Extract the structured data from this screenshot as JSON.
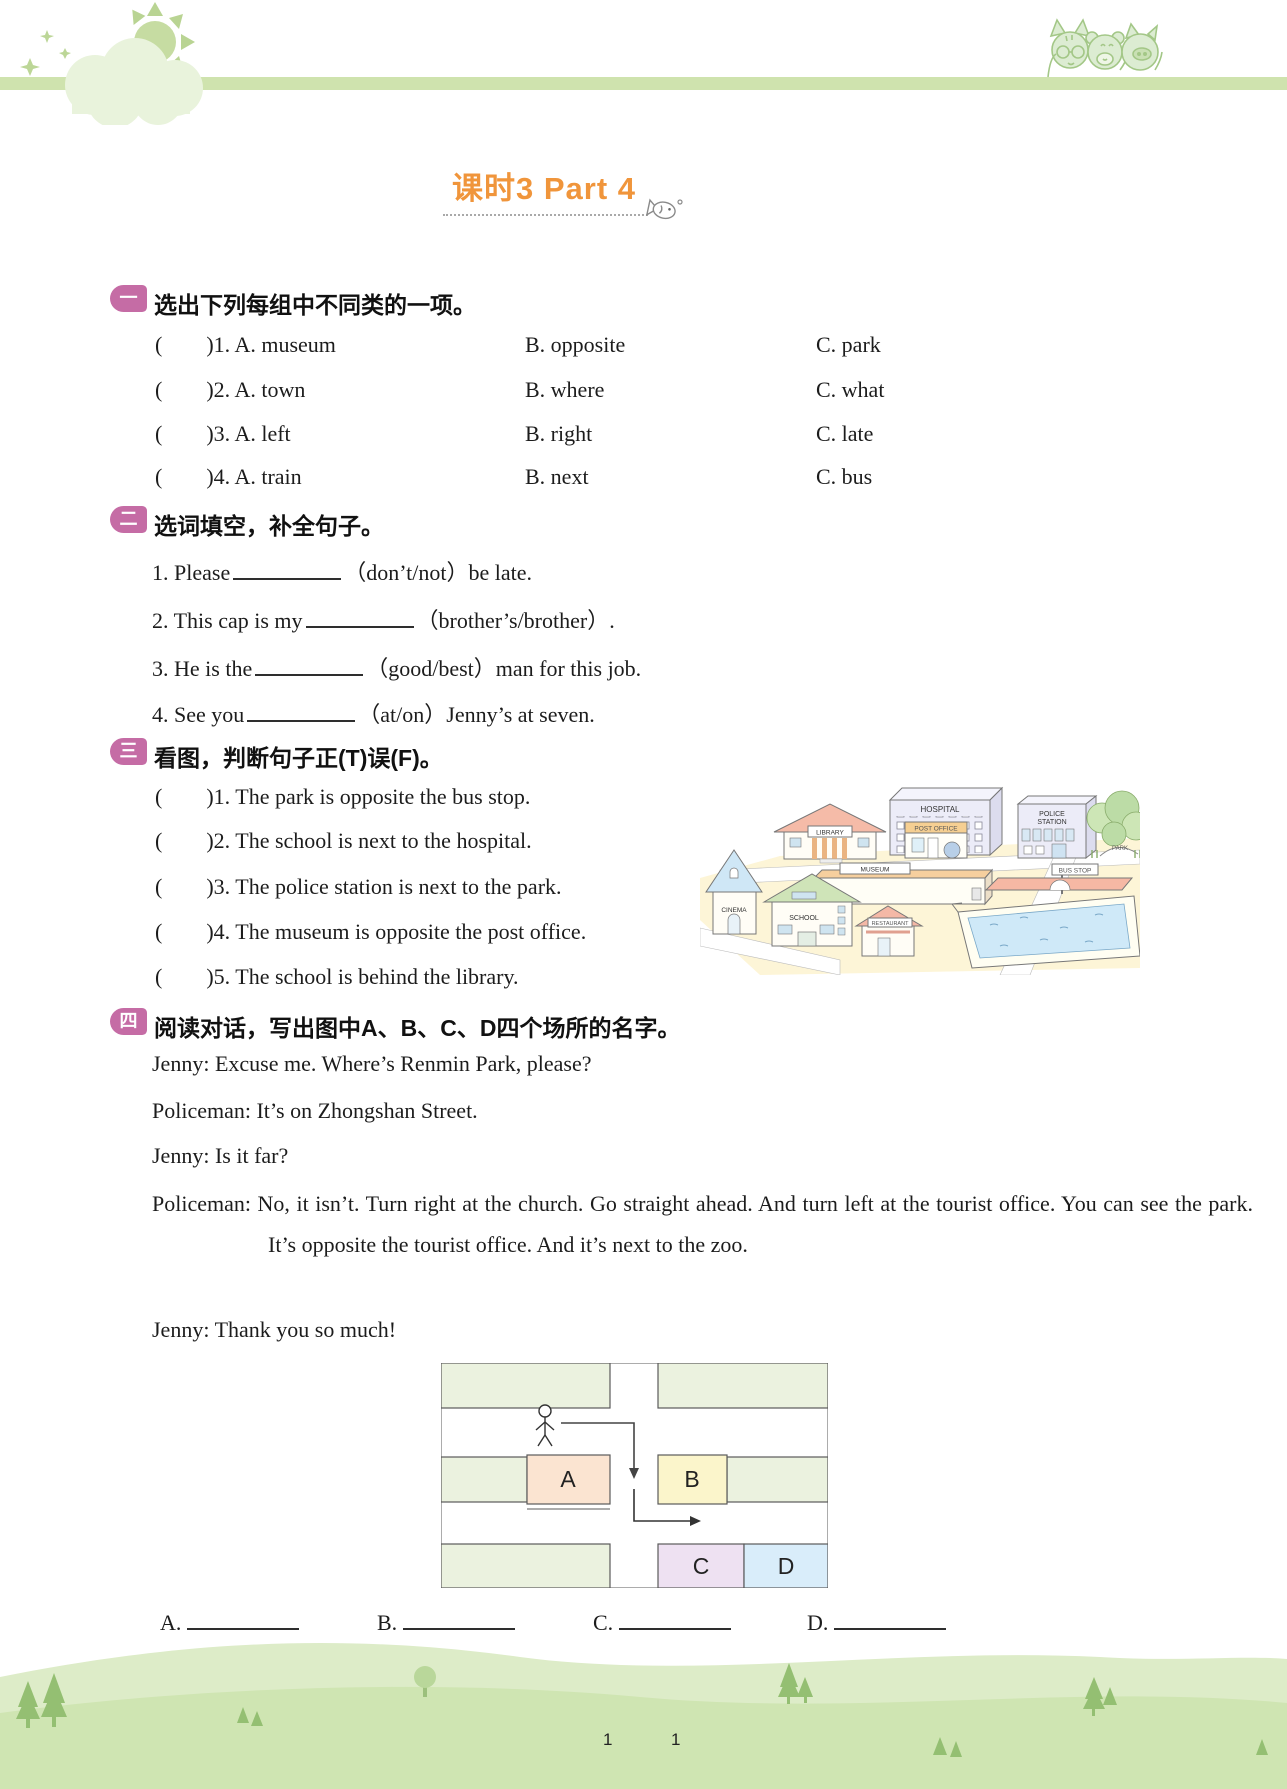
{
  "title": {
    "text": "课时3  Part 4"
  },
  "ui": {
    "paren_open": "(",
    "paren_close": ")"
  },
  "s1": {
    "badge": "一",
    "heading": "选出下列每组中不同类的一项。",
    "rows": [
      {
        "num": "1.",
        "a": "A. museum",
        "b": "B. opposite",
        "c": "C. park"
      },
      {
        "num": "2.",
        "a": "A. town",
        "b": "B. where",
        "c": "C. what"
      },
      {
        "num": "3.",
        "a": "A. left",
        "b": "B. right",
        "c": "C. late"
      },
      {
        "num": "4.",
        "a": "A. train",
        "b": "B. next",
        "c": "C. bus"
      }
    ]
  },
  "s2": {
    "badge": "二",
    "heading": "选词填空，补全句子。",
    "items": [
      {
        "n": "1.",
        "pre": "Please",
        "post": "（don’t/not）be late."
      },
      {
        "n": "2.",
        "pre": "This cap is my",
        "post": "（brother’s/brother）."
      },
      {
        "n": "3.",
        "pre": "He is the",
        "post": "（good/best）man for this job."
      },
      {
        "n": "4.",
        "pre": "See you",
        "post": "（at/on）Jenny’s at seven."
      }
    ]
  },
  "s3": {
    "badge": "三",
    "heading": "看图，判断句子正(T)误(F)。",
    "rows": [
      {
        "num": "1.",
        "text": "The park is opposite the bus stop."
      },
      {
        "num": "2.",
        "text": "The school is next to the hospital."
      },
      {
        "num": "3.",
        "text": "The police station is next to the park."
      },
      {
        "num": "4.",
        "text": "The museum is opposite the post office."
      },
      {
        "num": "5.",
        "text": "The school is behind the library."
      }
    ],
    "map": {
      "hospital": "HOSPITAL",
      "library": "LIBRARY",
      "post_office": "POST OFFICE",
      "police_station_1": "POLICE",
      "police_station_2": "STATION",
      "park": "PARK",
      "museum": "MUSEUM",
      "bus_stop": "BUS STOP",
      "cinema": "CINEMA",
      "school": "SCHOOL",
      "restaurant": "RESTAURANT"
    }
  },
  "s4": {
    "badge": "四",
    "heading": "阅读对话，写出图中A、B、C、D四个场所的名字。",
    "dialogue": [
      {
        "speaker": "Jenny:",
        "text": "Excuse me. Where’s Renmin Park, please?"
      },
      {
        "speaker": "Policeman:",
        "text": "It’s on Zhongshan Street."
      },
      {
        "speaker": "Jenny:",
        "text": "Is it far?"
      },
      {
        "speaker": "Policeman:",
        "text": "No, it isn’t. Turn right at the church. Go straight ahead. And turn left at the tourist office. You can see the park. It’s opposite the tourist office. And it’s next to the zoo."
      },
      {
        "speaker": "Jenny:",
        "text": "Thank you so much!"
      }
    ],
    "diagram": {
      "a": "A",
      "b": "B",
      "c": "C",
      "d": "D"
    },
    "answers": [
      "A.",
      "B.",
      "C.",
      "D."
    ]
  },
  "footer": {
    "page_left": "1",
    "page_right": "1"
  },
  "colors": {
    "accent_orange": "#f0953b",
    "badge_pink": "#c56ca5",
    "header_bar_green": "#cfe3ae",
    "hill_green_light": "#ddecc8",
    "hill_green": "#cfe5b2",
    "block_green": "#ebf2df",
    "block_a_peach": "#fbe4d1",
    "block_b_yellow": "#fbf5cb",
    "block_c_lavender": "#eee1f2",
    "block_d_blue": "#d9edfa"
  }
}
